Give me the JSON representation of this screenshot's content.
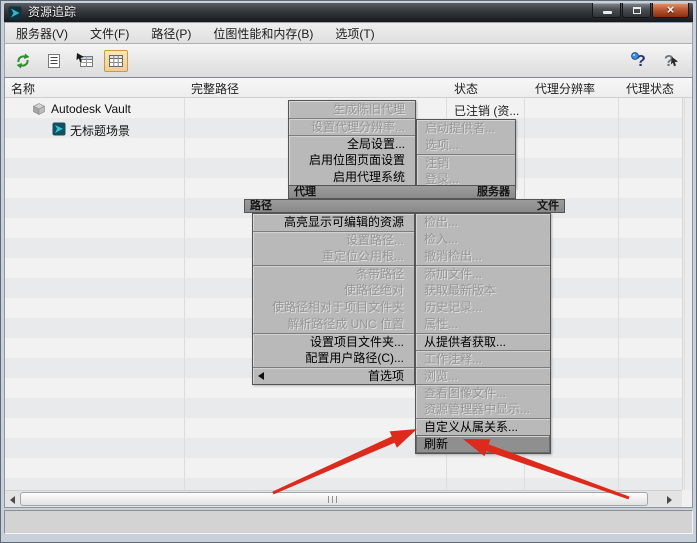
{
  "window": {
    "title": "资源追踪"
  },
  "menubar": {
    "items": [
      {
        "label": "服务器(V)"
      },
      {
        "label": "文件(F)"
      },
      {
        "label": "路径(P)"
      },
      {
        "label": "位图性能和内存(B)"
      },
      {
        "label": "选项(T)"
      }
    ]
  },
  "toolbar": {
    "buttons": [
      {
        "name": "refresh"
      },
      {
        "name": "list-view"
      },
      {
        "name": "table-pointer"
      },
      {
        "name": "grid-view",
        "active": true
      }
    ],
    "help_buttons": [
      {
        "name": "help"
      },
      {
        "name": "context-help"
      }
    ]
  },
  "table": {
    "columns": [
      "名称",
      "完整路径",
      "状态",
      "代理分辨率",
      "代理状态"
    ],
    "rows": [
      {
        "name": "Autodesk Vault",
        "full_path": "",
        "status": "已注销 (资...",
        "proxy_resolution": "",
        "proxy_status": ""
      },
      {
        "name": "无标题场景",
        "full_path": "",
        "status": "",
        "proxy_resolution": "",
        "proxy_status": ""
      }
    ]
  },
  "quad_menu": {
    "proxy": {
      "label": "代理",
      "items": [
        {
          "text": "生成陈旧代理",
          "enabled": false
        },
        {
          "text": "设置代理分辨率...",
          "enabled": false
        },
        {
          "text": "全局设置...",
          "enabled": true
        },
        {
          "text": "启用位图页面设置",
          "enabled": true
        },
        {
          "text": "启用代理系统",
          "enabled": true
        }
      ]
    },
    "server": {
      "label": "服务器",
      "items": [
        {
          "text": "启动提供者...",
          "enabled": false
        },
        {
          "text": "选项...",
          "enabled": false
        },
        {
          "text": "注销",
          "enabled": false
        },
        {
          "text": "登录...",
          "enabled": false
        }
      ]
    },
    "path": {
      "label": "路径",
      "items": [
        {
          "text": "高亮显示可编辑的资源",
          "enabled": true
        },
        {
          "text": "设置路径...",
          "enabled": false
        },
        {
          "text": "重定位公用根...",
          "enabled": false
        },
        {
          "text": "条带路径",
          "enabled": false
        },
        {
          "text": "使路径绝对",
          "enabled": false
        },
        {
          "text": "使路径相对于项目文件夹",
          "enabled": false
        },
        {
          "text": "解析路径成 UNC 位置",
          "enabled": false
        },
        {
          "text": "设置项目文件夹...",
          "enabled": true
        },
        {
          "text": "配置用户路径(C)...",
          "enabled": true
        },
        {
          "text": "首选项",
          "enabled": true,
          "has_submenu": true
        }
      ]
    },
    "file": {
      "label": "文件",
      "items": [
        {
          "text": "检出...",
          "enabled": false
        },
        {
          "text": "检入...",
          "enabled": false
        },
        {
          "text": "撤消检出...",
          "enabled": false
        },
        {
          "text": "添加文件...",
          "enabled": false
        },
        {
          "text": "获取最新版本",
          "enabled": false
        },
        {
          "text": "历史记录...",
          "enabled": false
        },
        {
          "text": "属性...",
          "enabled": false
        },
        {
          "text": "从提供者获取...",
          "enabled": true
        },
        {
          "text": "工作注释...",
          "enabled": false
        },
        {
          "text": "浏览...",
          "enabled": false
        },
        {
          "text": "查看图像文件...",
          "enabled": false
        },
        {
          "text": "资源管理器中显示...",
          "enabled": false
        },
        {
          "text": "自定义从属关系...",
          "enabled": true
        },
        {
          "text": "刷新",
          "enabled": true,
          "highlighted": true
        }
      ]
    }
  },
  "annotations": {
    "arrow_color": "#de2a1b",
    "arrows_point_to": "刷新"
  },
  "colors": {
    "titlebar": "#2d3136",
    "menu_bg": "#b9b9b9",
    "menu_disabled_text": "#969696",
    "menu_highlight_bg": "#8f8f8f",
    "toolbar_active_bg": "#f2d593",
    "arrow_red": "#de2a1b"
  }
}
